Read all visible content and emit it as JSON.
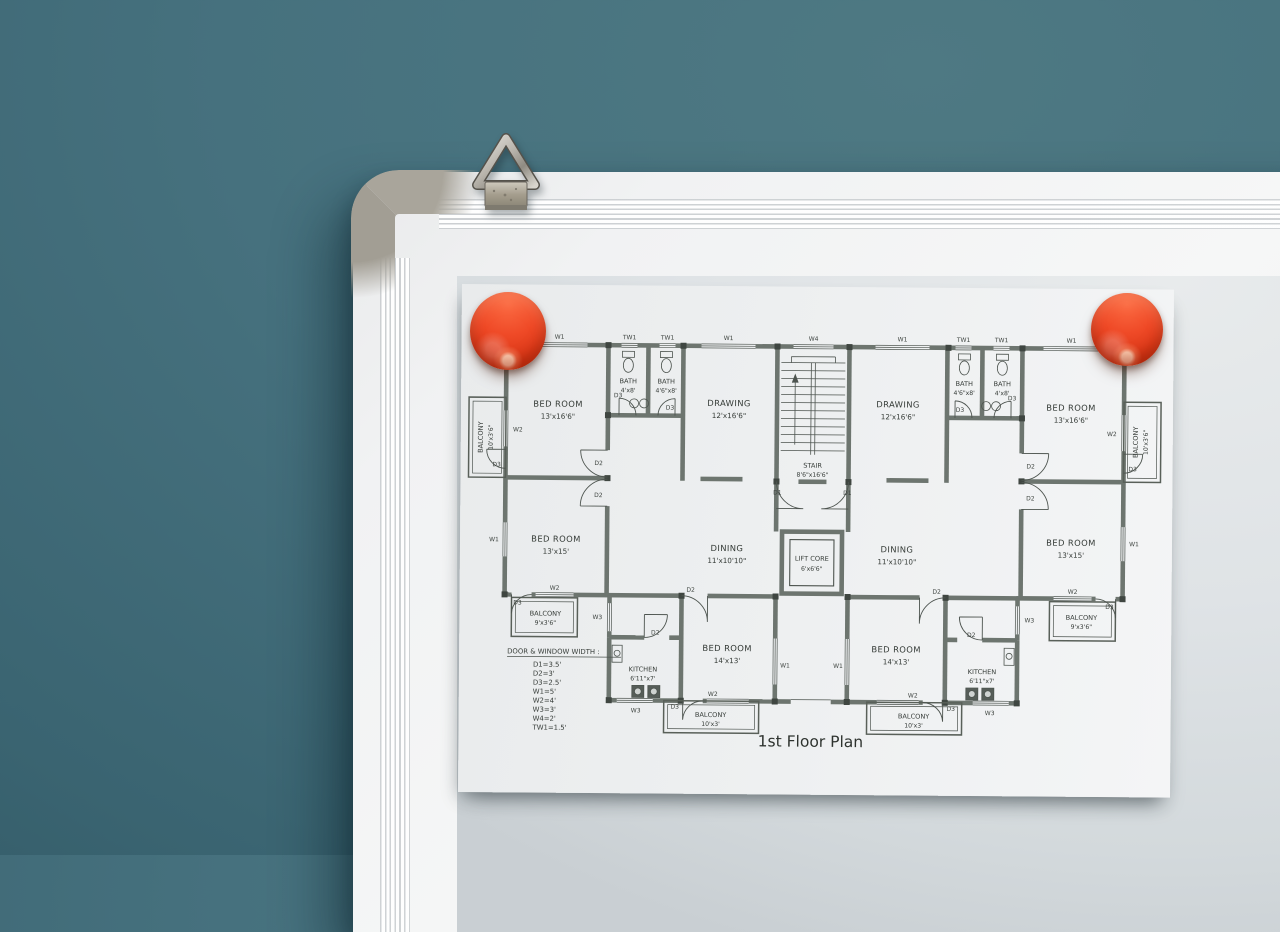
{
  "colors": {
    "wall": "#46717e",
    "wall-light": "#4e7983",
    "wall-dark": "#3a6471",
    "frame": "#f1f2f3",
    "corner-cap": "#a9a59b",
    "board": "#dfe3e6",
    "paper": "#eef0f1",
    "magnet": "#ef4a27",
    "magnet-light": "#fb6a42",
    "magnet-dark": "#b22b0e"
  },
  "plan": {
    "title": "1st Floor Plan",
    "legend": {
      "title": "DOOR & WINDOW WIDTH :",
      "items": [
        "D1=3.5'",
        "D2=3'",
        "D3=2.5'",
        "W1=5'",
        "W2=4'",
        "W3=3'",
        "W4=2'",
        "TW1=1.5'"
      ]
    },
    "labels": {
      "d1": "D1",
      "d2": "D2",
      "d3": "D3",
      "w1": "W1",
      "w2": "W2",
      "w3": "W3",
      "w4": "W4",
      "tw1": "TW1"
    },
    "rooms": {
      "balcony_tl": {
        "name": "BALCONY",
        "size": "10'x3'6\""
      },
      "bed_tl": {
        "name": "BED ROOM",
        "size": "13'x16'6\""
      },
      "bath1": {
        "name": "BATH",
        "size": "4'x8'"
      },
      "bath2": {
        "name": "BATH",
        "size": "4'6\"x8'"
      },
      "drawing_l": {
        "name": "DRAWING",
        "size": "12'x16'6\""
      },
      "stair": {
        "name": "STAIR",
        "size": "8'6\"x16'6\""
      },
      "drawing_r": {
        "name": "DRAWING",
        "size": "12'x16'6\""
      },
      "bath3": {
        "name": "BATH",
        "size": "4'6\"x8'"
      },
      "bath4": {
        "name": "BATH",
        "size": "4'x8'"
      },
      "bed_tr": {
        "name": "BED ROOM",
        "size": "13'x16'6\""
      },
      "balcony_tr": {
        "name": "BALCONY",
        "size": "10'x3'6\""
      },
      "bed_ml": {
        "name": "BED ROOM",
        "size": "13'x15'"
      },
      "dining_l": {
        "name": "DINING",
        "size": "11'x10'10\""
      },
      "lift": {
        "name": "LIFT CORE",
        "size": "6'x6'6\""
      },
      "dining_r": {
        "name": "DINING",
        "size": "11'x10'10\""
      },
      "bed_mr": {
        "name": "BED ROOM",
        "size": "13'x15'"
      },
      "balcony_ml": {
        "name": "BALCONY",
        "size": "9'x3'6\""
      },
      "balcony_mr": {
        "name": "BALCONY",
        "size": "9'x3'6\""
      },
      "kitchen_l": {
        "name": "KITCHEN",
        "size": "6'11\"x7'"
      },
      "bed_bl": {
        "name": "BED ROOM",
        "size": "14'x13'"
      },
      "bed_br": {
        "name": "BED ROOM",
        "size": "14'x13'"
      },
      "kitchen_r": {
        "name": "KITCHEN",
        "size": "6'11\"x7'"
      },
      "balcony_bl": {
        "name": "BALCONY",
        "size": "10'x3'"
      },
      "balcony_br": {
        "name": "BALCONY",
        "size": "10'x3'"
      }
    }
  }
}
